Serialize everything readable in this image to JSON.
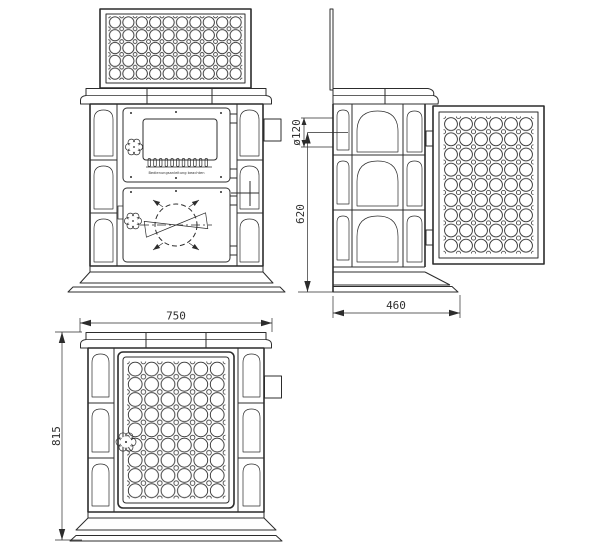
{
  "drawing": {
    "background": "#ffffff",
    "line_color": "#2c2c2c"
  },
  "dimensions": {
    "front_width": "750",
    "front_height": "815",
    "side_depth": "460",
    "flue_center_height": "620",
    "flue_diameter": "ø120"
  },
  "labels": {
    "door_instruction": "Bedienungsanleitung beachten"
  }
}
